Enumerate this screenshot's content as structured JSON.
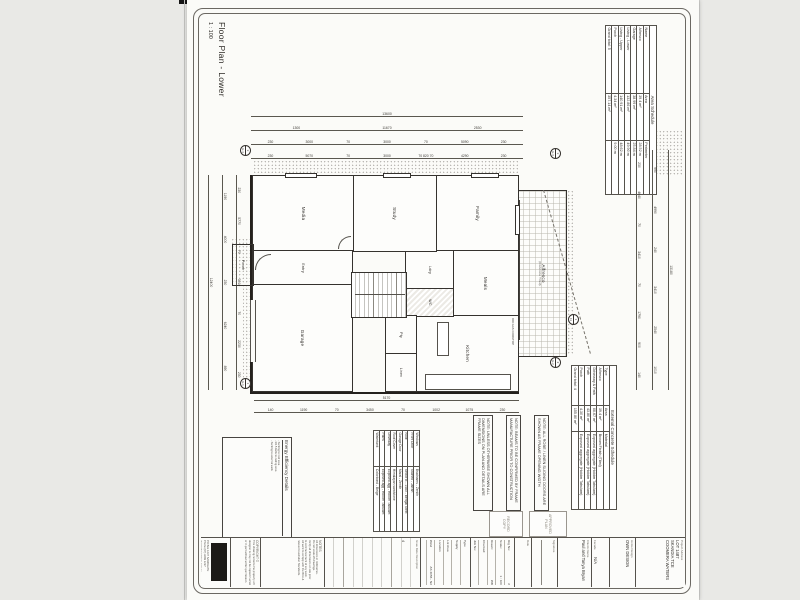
{
  "sheet": {
    "title": "Floor Plan - Lower",
    "scale": "1 : 100"
  },
  "area_schedule": {
    "title": "Area Schedule",
    "columns": [
      "Name",
      "Area",
      "Perimeter"
    ],
    "rows": [
      [
        "Alfresco",
        "39.4 m²",
        "28.52 m"
      ],
      [
        "Garage",
        "38.99 m²",
        "25.84 m"
      ],
      [
        "Living - Lower",
        "132.86 m²",
        "49.90 m"
      ],
      [
        "Living - Upper",
        "140.91 m²",
        "48.62 m"
      ],
      [
        "Porch",
        "4.34 m²",
        "9.00 m"
      ]
    ],
    "total_label": "Grand total: 5",
    "total_value": "357.14 m²"
  },
  "concrete_schedule": {
    "title": "External Concrete Schedule",
    "columns": [
      "Type",
      "Area",
      "Material"
    ],
    "rows": [
      [
        "Alfresco",
        "39.4 m²",
        "Broom Finish (Tiled)"
      ],
      [
        "Driveway & Path",
        "66.67 m²",
        "Exposed aggregate (Holcim Tabulam)"
      ],
      [
        "Path",
        "43.80 m²",
        "Exposed aggregate (Holcim Tabulam)"
      ],
      [
        "Porch",
        "4.30 m²",
        "Exposed aggregate (Holcim Tabulam)"
      ]
    ],
    "total_label": "Grand total: 4",
    "total_value": "155.80 m²"
  },
  "finishes_schedule": {
    "rows": [
      [
        "Windows",
        "Bradnams - Zenith"
      ],
      [
        "Front Door",
        "Stained - Jarrah"
      ],
      [
        "Roof",
        "Sector B - 1480 - Bengal Steel"
      ],
      [
        "Garage Door",
        "Maral - Zenith"
      ],
      [
        "Roof Cover",
        "Himalayan sandstone"
      ],
      [
        "Driveway",
        "Exposed agg - Holcim Tabulam"
      ],
      [
        "Paths",
        "Exposed agg - Holcim Tabulam"
      ],
      [
        "Watertank",
        "Colorbond - Beige"
      ]
    ]
  },
  "notes": {
    "n1": "NOTE: ALL ROBE / LINEN SLIDING DOORS ARE SHOWN AS FRAME OPENING WIDTH",
    "n2": "NOTE: BEAMS TO BE CONFIRMED BY FRAME MANUFACTURE PRIOR TO CONSTRUCTION",
    "n3": "NOTE: UNLESS OTHERWISE SHOWN ALL DIMENSIONS ON PLAN AND DETAILS ARE FRAME SIZES"
  },
  "energy": {
    "title": "Energy Efficiency Details",
    "items": [
      "-  Sarking to roof area",
      "-  R2.5 batts to ceiling area",
      "-  Sarking to external walls"
    ]
  },
  "rooms": {
    "media": "Media",
    "study": "Study",
    "family": "Family",
    "meals": "Meals",
    "kitchen": "Kitchen",
    "entry": "Entry",
    "porch": "Porch",
    "garage": "Garage",
    "alfresco": "Alfresco",
    "alfresco_sub": "(Concrete Tiled)",
    "ldry": "Ldry",
    "wc": "WC",
    "pty": "Pty",
    "linen": "Linen",
    "cooktop_note": "900 GAS COOKTOP"
  },
  "dims": {
    "top": {
      "r1": "13180",
      "r2": "990|4990|240|3410|2540|1010",
      "r3": "230|4640|70|3410|70|1790|900|140"
    },
    "left": {
      "r1": "13600",
      "r2": "1300|11670|2530",
      "r3": "230|3000|70|3000|70|5090|230",
      "r4": "230|5070|70|3000|70 820 70|4290|230"
    },
    "right": {
      "r1": "5170",
      "r2": "140|1190|70|3450|70|1002|1075|230"
    },
    "bottom": {
      "r1": "230|5770|70|3010|70|2230|230",
      "r2": "1190|4000|230|6240|890",
      "r3": "12400"
    }
  },
  "markers": {
    "m1": {
      "num": "3",
      "label": "E-4"
    },
    "m2": {
      "num": "1",
      "label": "E-1"
    },
    "m3": {
      "num": "3",
      "label": "E-3"
    },
    "m4": {
      "num": "2",
      "label": "E-2"
    },
    "m5": {
      "num": "1",
      "label": "11"
    }
  },
  "stamps": {
    "s1": "APPROVED\nPLAN",
    "s2": "RECORD\nCOPY"
  },
  "title_block": {
    "project_address_label": "Project Address",
    "project_address": "LOT 1487\nSKANDIA TCE\nCOOMERA WATERS",
    "home_design_label": "Home Design",
    "home_design": "OWN DESIGN",
    "facade_label": "Facade",
    "facade": "N/A",
    "clients_label": "Clients Name",
    "clients": "Paul and Tanya Bryan",
    "signature_label": "Signature",
    "date_label": "Date",
    "drg_fields": [
      [
        "Drg No:",
        "2"
      ],
      [
        "Scale:",
        "1 : 100"
      ],
      [
        "Drawn:",
        "WB"
      ],
      [
        "Checked:",
        ""
      ],
      [
        "Job No:",
        ""
      ]
    ],
    "site_fields": [
      [
        "Type",
        ""
      ],
      [
        "Supply",
        ""
      ],
      [
        "Lot Area",
        ""
      ],
      [
        "Location",
        ""
      ],
      [
        "Wind",
        "AS 4055 - N2"
      ]
    ],
    "revision_columns": "Issue   Date   Description",
    "revision_entry": "4",
    "notes_title": "NOTES",
    "notes_lines": [
      "All dimensions in millimetres.",
      "Do not scale off drawings.",
      "Verify all dimensions on site prior",
      "to commencement of any work.",
      "All work to comply with the BCA &",
      "relevant Australian Standards."
    ],
    "copyright_title": "COPYRIGHT ©",
    "copyright_lines": [
      "This drawing remains the property of the",
      "designer & may not be copied in whole",
      "or in part without written permission."
    ],
    "company_lines": [
      "PO Box 1237 SANDGATE",
      "Phone (07) 3269 1237",
      "design@ownplans.com.au"
    ]
  }
}
